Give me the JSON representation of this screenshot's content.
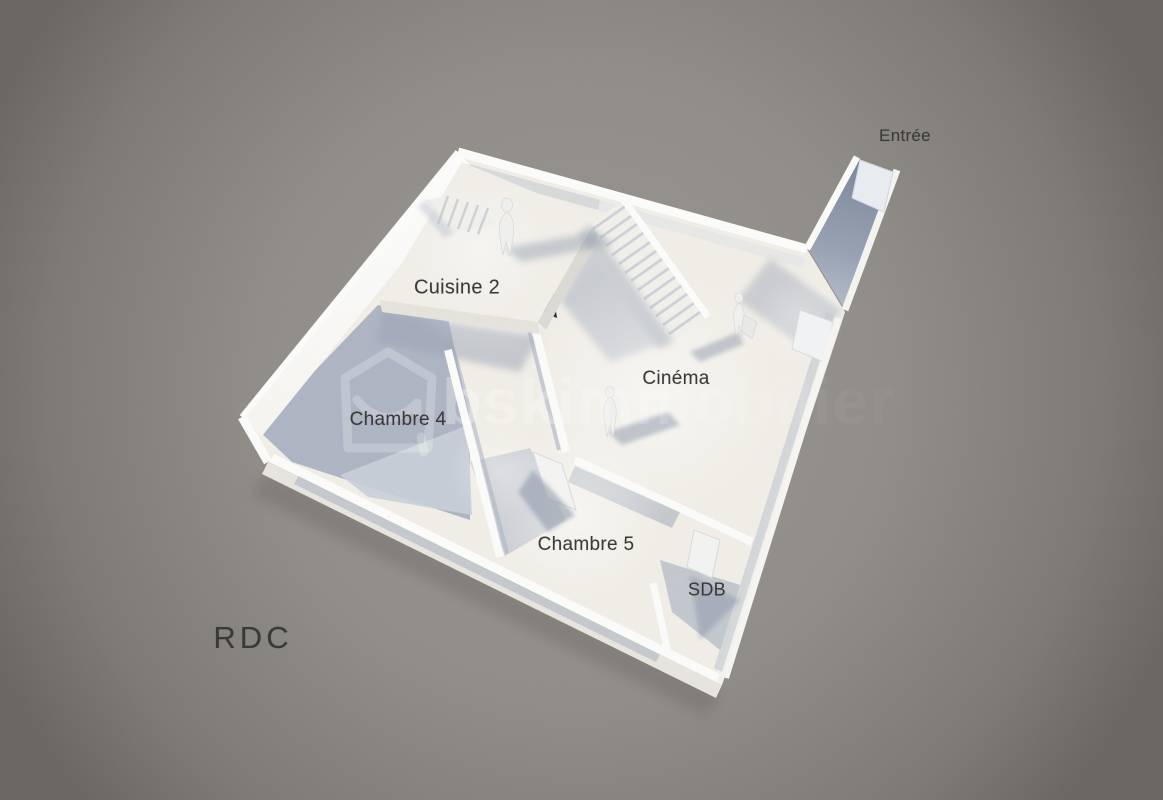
{
  "scene": {
    "type": "3d-floor-plan-render",
    "floor_title": "RDC",
    "room_labels": {
      "entree": "Entrée",
      "cuisine": "Cuisine 2",
      "cinema": "Cinéma",
      "chambre4": "Chambre 4",
      "chambre5": "Chambre 5",
      "sdb": "SDB"
    },
    "watermark": {
      "brand": "bskimmobilier"
    },
    "figures_count": 3,
    "staircase_count": 2,
    "palette": {
      "background_center": "#9a9591",
      "background_edge": "#6b6764",
      "floor_lit": "#f1eee7",
      "wall_white": "#fcfcfa",
      "shadow_blue_gray": "#a7b0c0",
      "void_dark": "#23272d",
      "label_text": "#3b3a38",
      "watermark_white": "#ffffff"
    }
  }
}
